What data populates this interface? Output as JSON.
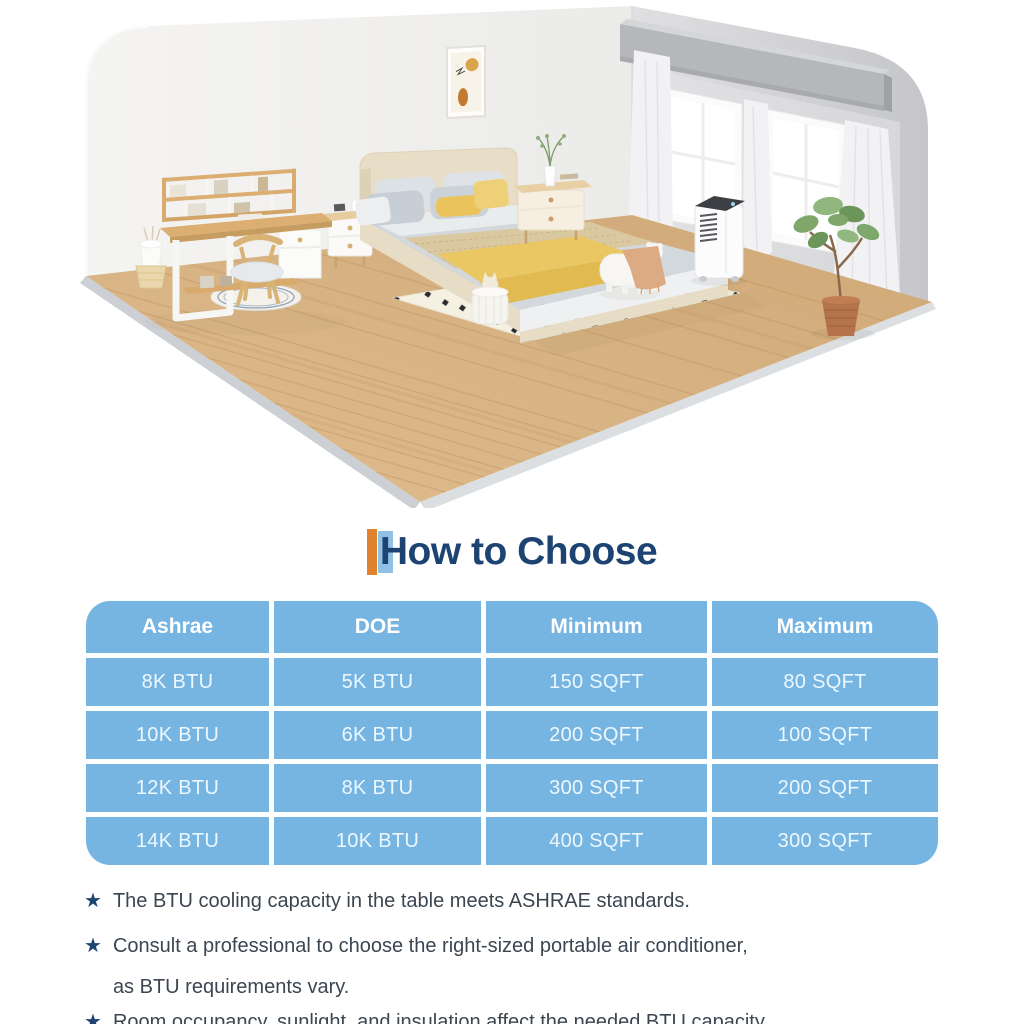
{
  "meta": {
    "width": 1024,
    "height": 1024,
    "background": "#ffffff"
  },
  "scene": {
    "description": "isometric bedroom illustration with portable air conditioner",
    "items": [
      "left-wall",
      "right-wall",
      "windows",
      "curtains",
      "valance",
      "wall-art",
      "wood-floor",
      "desk-with-hutch",
      "desk-chair",
      "round-rug",
      "wastebasket",
      "storage-basket",
      "nightstand-left",
      "nightstand-right",
      "bed",
      "pillows",
      "yellow-throw",
      "tan-runner",
      "polka-dot-rug",
      "pet-stool",
      "toy-basket",
      "portable-air-conditioner",
      "potted-plant"
    ],
    "colors": {
      "wall_light": "#f1f0ee",
      "wall_gray": "#d2d3d5",
      "floor_wood": "#d7b285",
      "floor_edge_gray": "#ccd0d4",
      "bed_frame_beige": "#e8ddc6",
      "bedding_gray": "#d3d8dc",
      "accent_yellow": "#eac660",
      "rug_cream": "#f4f1e2",
      "plant_green": "#7fa76b",
      "pot_terracotta": "#b4734a",
      "ac_white": "#fcfcfd",
      "ac_top_dark": "#3c3f44"
    }
  },
  "heading": {
    "title": "How to Choose",
    "text_color": "#1d4373",
    "accent_orange": "#e0812e",
    "accent_blue": "#8ec1e4"
  },
  "table": {
    "cell_color": "#76b5e1",
    "header_text_color": "#ffffff",
    "body_text_color": "#ecf7fe",
    "header": [
      "Ashrae",
      "DOE",
      "Minimum",
      "Maximum"
    ],
    "rows": [
      [
        "8K BTU",
        "5K BTU",
        "150 SQFT",
        "80 SQFT"
      ],
      [
        "10K BTU",
        "6K BTU",
        "200 SQFT",
        "100 SQFT"
      ],
      [
        "12K BTU",
        "8K BTU",
        "300 SQFT",
        "200 SQFT"
      ],
      [
        "14K BTU",
        "10K BTU",
        "400 SQFT",
        "300 SQFT"
      ]
    ]
  },
  "chart_data": {
    "type": "table",
    "title": "How to Choose",
    "columns": [
      "Ashrae",
      "DOE",
      "Minimum",
      "Maximum"
    ],
    "rows": [
      [
        "8K BTU",
        "5K BTU",
        "150 SQFT",
        "80 SQFT"
      ],
      [
        "10K BTU",
        "6K BTU",
        "200 SQFT",
        "100 SQFT"
      ],
      [
        "12K BTU",
        "8K BTU",
        "300 SQFT",
        "200 SQFT"
      ],
      [
        "14K BTU",
        "10K BTU",
        "400 SQFT",
        "300 SQFT"
      ]
    ]
  },
  "notes": {
    "bullet_glyph": "★",
    "star_color": "#1e4473",
    "text_color": "#3c4650",
    "items": [
      {
        "lines": [
          "The BTU cooling capacity in the table meets ASHRAE standards."
        ]
      },
      {
        "lines": [
          "Consult a professional to choose the right-sized portable air conditioner,",
          "as BTU requirements vary."
        ]
      },
      {
        "lines": [
          "Room occupancy, sunlight, and insulation affect the needed BTU capacity."
        ]
      }
    ]
  }
}
